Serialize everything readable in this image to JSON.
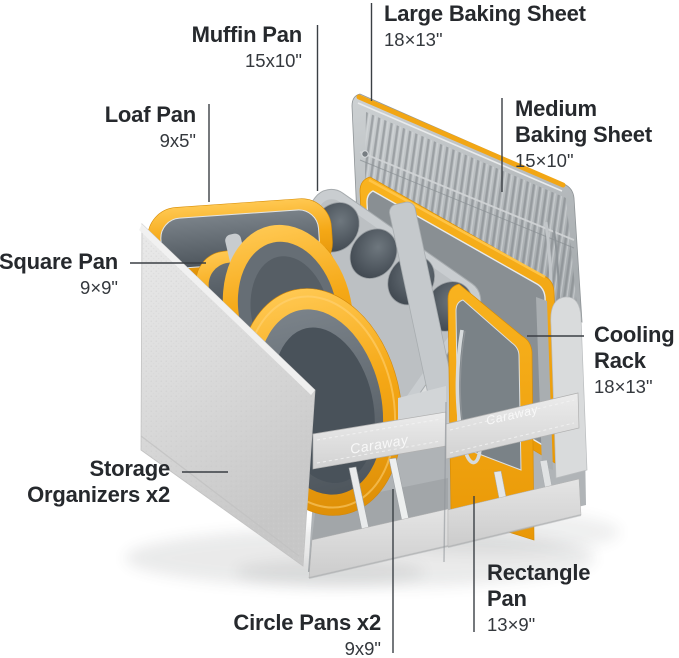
{
  "product": {
    "brand_label": "Caraway",
    "colors": {
      "accent_yellow": "#F3A512",
      "pan_interior_gray": "#565E65",
      "sheet_silver": "#B4B9BC",
      "organizer_fabric": "#D9D9D9",
      "callout_line": "#3A3F44",
      "label_text": "#26292D",
      "dims_text": "#34383D",
      "background": "#FFFFFF"
    }
  },
  "callouts": [
    {
      "id": "large-baking-sheet",
      "name_lines": [
        "Large Baking Sheet"
      ],
      "dims": "18×13\""
    },
    {
      "id": "muffin-pan",
      "name_lines": [
        "Muffin Pan"
      ],
      "dims": "15x10\""
    },
    {
      "id": "loaf-pan",
      "name_lines": [
        "Loaf Pan"
      ],
      "dims": "9x5\""
    },
    {
      "id": "medium-baking-sheet",
      "name_lines": [
        "Medium",
        "Baking Sheet"
      ],
      "dims": "15×10\""
    },
    {
      "id": "square-pan",
      "name_lines": [
        "Square Pan"
      ],
      "dims": "9×9\""
    },
    {
      "id": "cooling-rack",
      "name_lines": [
        "Cooling",
        "Rack"
      ],
      "dims": "18×13\""
    },
    {
      "id": "storage-organizers",
      "name_lines": [
        "Storage",
        "Organizers x2"
      ],
      "dims": ""
    },
    {
      "id": "circle-pans",
      "name_lines": [
        "Circle Pans x2"
      ],
      "dims": "9x9\""
    },
    {
      "id": "rectangle-pan",
      "name_lines": [
        "Rectangle",
        "Pan"
      ],
      "dims": "13×9\""
    }
  ]
}
